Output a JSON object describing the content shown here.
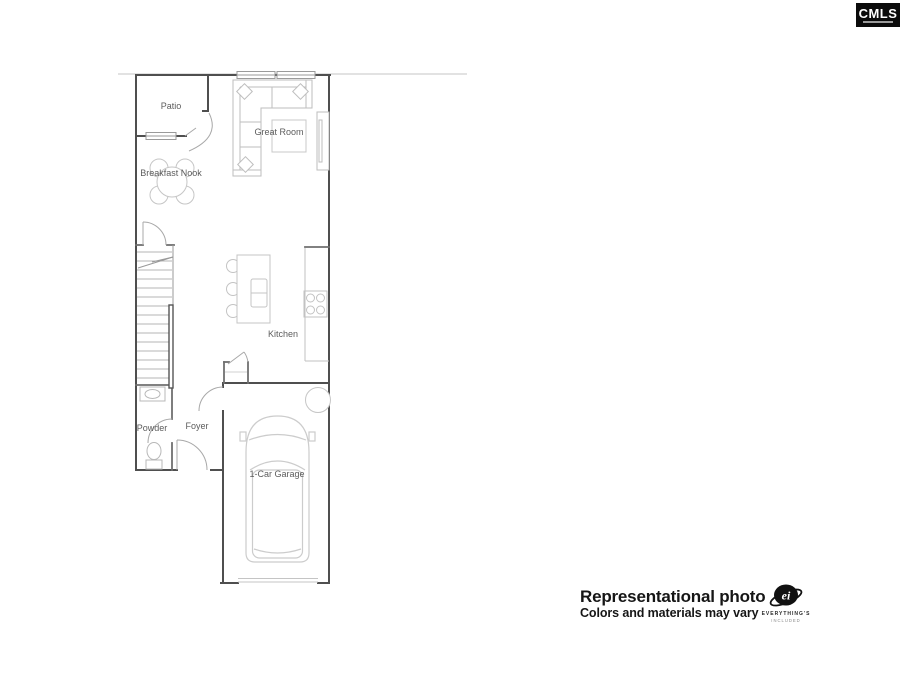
{
  "page": {
    "background": "#ffffff"
  },
  "cmls_logo": {
    "text": "CMLS",
    "bg": "#0b0b0b",
    "fg": "#ffffff"
  },
  "floor_plan": {
    "rooms": [
      {
        "id": "patio",
        "label": "Patio"
      },
      {
        "id": "great-room",
        "label": "Great Room"
      },
      {
        "id": "breakfast-nook",
        "label": "Breakfast Nook"
      },
      {
        "id": "kitchen",
        "label": "Kitchen"
      },
      {
        "id": "powder",
        "label": "Powder"
      },
      {
        "id": "foyer",
        "label": "Foyer"
      },
      {
        "id": "garage",
        "label": "1-Car Garage"
      }
    ],
    "wall_color": "#4f4f4f",
    "furniture_color": "#c2c2c2",
    "label_color": "#5c5c5c"
  },
  "disclaimer": {
    "line1": "Representational photo",
    "line2": "Colors and materials may vary"
  },
  "ei_logo": {
    "monogram": "ei",
    "line1": "EVERYTHING'S",
    "line2": "INCLUDED"
  }
}
